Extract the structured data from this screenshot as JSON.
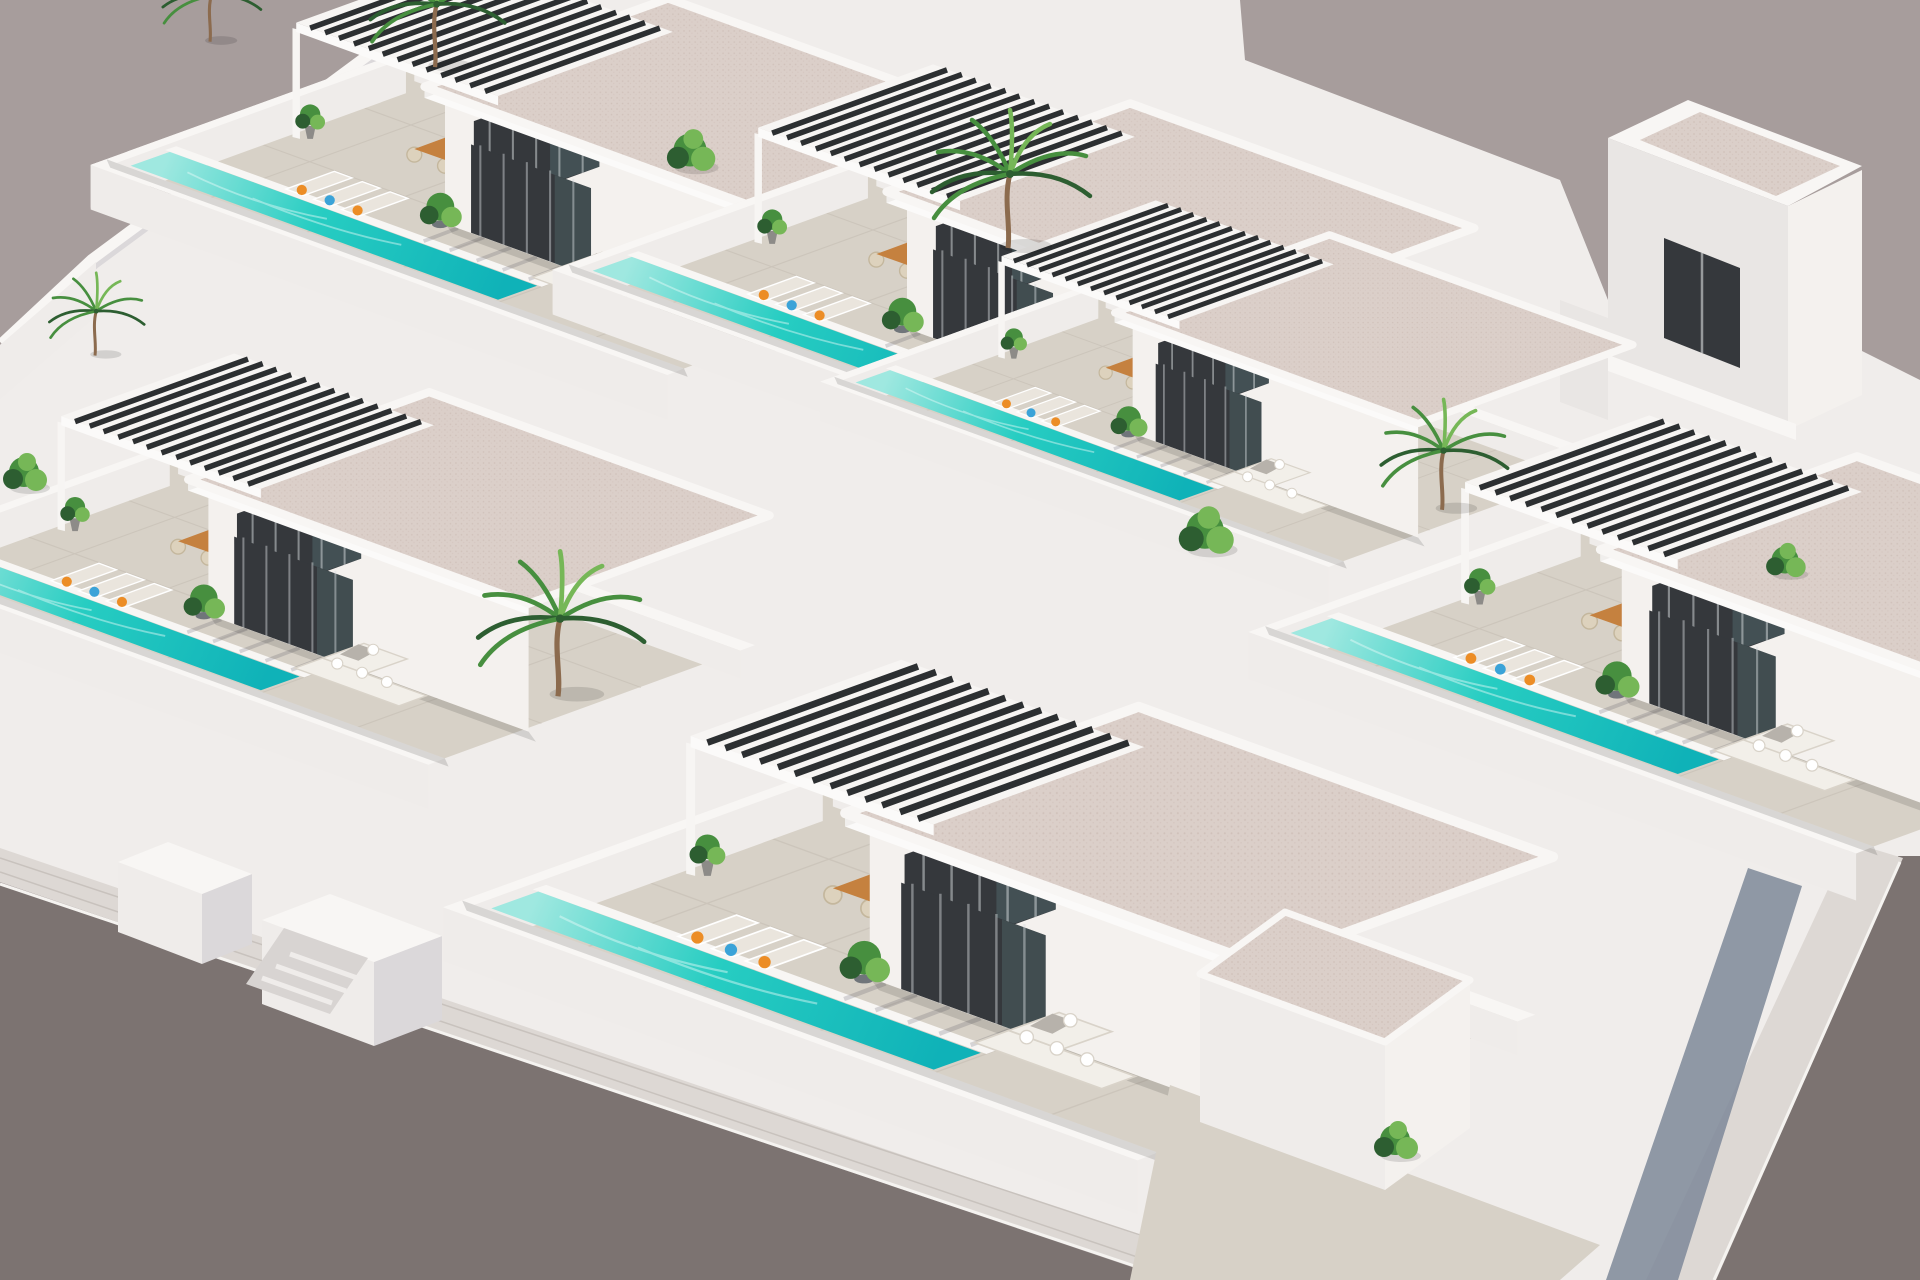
{
  "meta": {
    "title": "Aerial 3D render of a modern white villa development with private pools",
    "type": "architectural-render",
    "view": "isometric aerial",
    "time_of_day": "midday sun"
  },
  "palette": {
    "bg": "#a79d9c",
    "street": "#7c7371",
    "streetCurb": "#f5f3f0",
    "sidewalk": "#ddd8d4",
    "sidewalkLine": "#c8c2bd",
    "alleyShade": "#7e8899",
    "site": "#f0edeb",
    "paver": "#d7d1c7",
    "paverLine": "#c3bcb1",
    "wallTop": "#f8f6f4",
    "wallFaceLight": "#efecea",
    "wallFaceShade": "#dbd8da",
    "wallFaceDark": "#c9c8ce",
    "houseFaceBright": "#f4f1ee",
    "houseFaceSide": "#e9e6e4",
    "roofSideBright": "#fbfaf9",
    "roofSideShade": "#f0eeec",
    "facadeDark": "#35383c",
    "glassSheen": "#5e7d82",
    "curtain": "#d8dcdd",
    "pergolaFrame": "#f7f5f3",
    "pergolaSlat": "#2c2f31",
    "roofBase": "#dbcfc9",
    "roofDot": "#c7b5ad",
    "poolLight": "#9fe8e0",
    "poolMid": "#27cdc2",
    "poolDeep": "#0fb2b8",
    "poolSparkle": "#e8fbf8",
    "wood": "#c5813f",
    "woodLight": "#daa05f",
    "loungerCushion": "#eae5dd",
    "white": "#ffffff",
    "pillowOrange": "#ec8d26",
    "pillowBlue": "#3ba3d8",
    "sofa": "#f2efe9",
    "sofaEdge": "#d9d3c9",
    "throw": "#b7b2ab",
    "chair": "#ddd2bd",
    "chairEdge": "#c4b79d",
    "plantDark": "#2d5e31",
    "plantMid": "#478f3f",
    "plantLight": "#76b757",
    "trunk": "#8c6b4e",
    "potDark": "#70757a",
    "potGray": "#8d8b88",
    "stair": "#d8d4d2",
    "stairEdge": "#efecea"
  },
  "scene": {
    "description": "Six identical modern flat-roof villas arranged in staggered diagonal rows, each with a white-walled plot, long turquoise lap pool along the front boundary wall, paved terrace with sun loungers (orange and blue cushions), timber dining table with wicker chairs, white corner sofa, dark glazed facade, slatted pergola, and tropical plants. A grey asphalt street with white pavement borders the lower-left and right edges; a small two-storey tower stands at the back right.",
    "unit_features": [
      "flat roof with speckled finish",
      "black slatted pergola",
      "private lap pool",
      "three sun loungers with orange and blue pillows",
      "timber dining table with six wicker chairs",
      "white corner sofa with cushions and throw",
      "floor-to-ceiling dark glazed facade with curtains",
      "potted plants and palms"
    ],
    "villas": [
      {
        "id": "back-left",
        "x": 113,
        "y": 163,
        "s": 0.93
      },
      {
        "id": "back-center",
        "x": 575,
        "y": 268,
        "s": 0.93
      },
      {
        "id": "back-right",
        "x": 840,
        "y": 380,
        "s": 0.82
      },
      {
        "id": "mid-left",
        "x": -120,
        "y": 555,
        "s": 0.92
      },
      {
        "id": "front-center",
        "x": 470,
        "y": 905,
        "s": 1.12
      },
      {
        "id": "mid-right",
        "x": 1272,
        "y": 630,
        "s": 0.98
      }
    ],
    "palms": [
      {
        "x": 210,
        "y": 38,
        "s": 0.62
      },
      {
        "x": 435,
        "y": 62,
        "s": 0.85
      },
      {
        "x": 1008,
        "y": 242,
        "s": 1.0
      },
      {
        "x": 558,
        "y": 690,
        "s": 1.05
      },
      {
        "x": 1442,
        "y": 505,
        "s": 0.8
      },
      {
        "x": 95,
        "y": 352,
        "s": 0.6
      }
    ],
    "bushes": [
      {
        "x": 690,
        "y": 150,
        "s": 1.1
      },
      {
        "x": 1205,
        "y": 530,
        "s": 1.25
      },
      {
        "x": 1395,
        "y": 1140,
        "s": 1.0
      },
      {
        "x": 24,
        "y": 472,
        "s": 1.0
      },
      {
        "x": 1785,
        "y": 560,
        "s": 0.9
      }
    ]
  }
}
